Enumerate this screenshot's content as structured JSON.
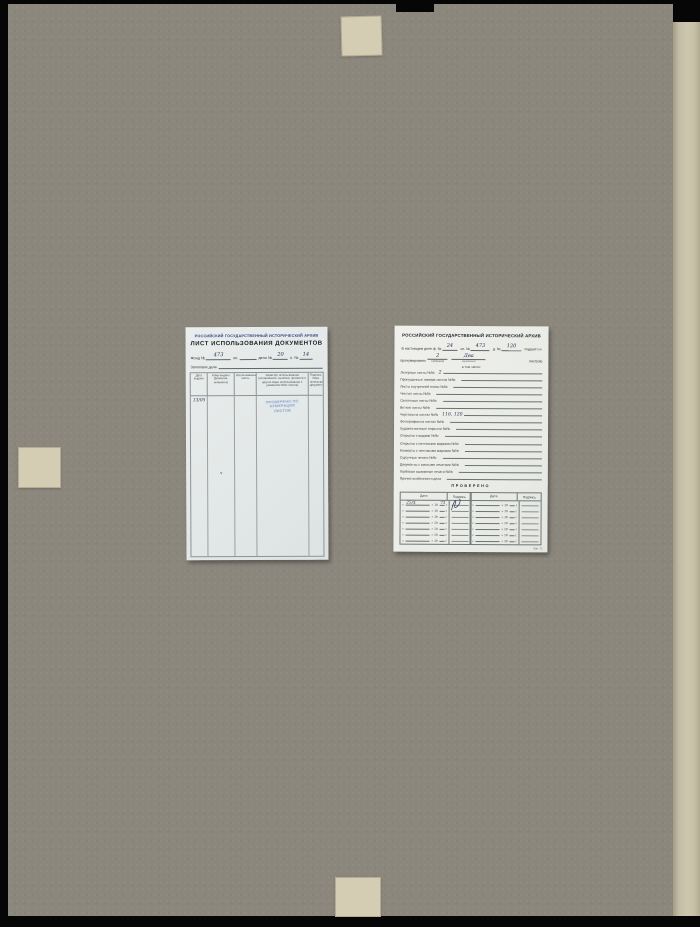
{
  "scene": {
    "backing_color": "#060606",
    "board_color": "#8b877d",
    "page_edge_color": "#c8c2a9",
    "tape_color": "#d4cdb3",
    "stamp_color": "#7b96c8"
  },
  "usage_sheet": {
    "archive": "РОССИЙСКИЙ ГОСУДАРСТВЕННЫЙ ИСТОРИЧЕСКИЙ АРХИВ",
    "title": "ЛИСТ ИСПОЛЬЗОВАНИЯ ДОКУМЕНТОВ",
    "fond_label": "Фонд №",
    "fond_value": "473",
    "op_label": "оп.",
    "op_value": "",
    "delo_label": "дело №",
    "delo_value": "20",
    "list_label": "л. №",
    "list_value": "14",
    "heading_label": "Заголовок дела",
    "columns": [
      "Дата выдачи",
      "Кому выдано (фамилия, инициалы)",
      "Использованные листы",
      "Характер использования (копирование, выписки, просмотр и другие виды использования с указанием №№ листов)",
      "Подпись лица, использовавшего документы"
    ],
    "entry_date": "13/05",
    "entry_mark": "ч",
    "stamp_lines": [
      "ПРОВЕРЕНО ПО",
      "НУМЕРАЦИИ",
      "ЛИСТОВ"
    ]
  },
  "verify_sheet": {
    "archive": "РОССИЙСКИЙ ГОСУДАРСТВЕННЫЙ ИСТОРИЧЕСКИЙ АРХИВ",
    "line1": {
      "label1": "В настоящем деле ф. №",
      "value1": "24",
      "label2": "оп. №",
      "value2": "473",
      "label3": "д. №",
      "value3": "120",
      "tail": "подшито и"
    },
    "line2": {
      "lead": "пронумеровано",
      "value_num": "2",
      "num_label": "(цифрами)",
      "value_text": "Два",
      "text_label": "(прописью)",
      "tail": "лист(ов)"
    },
    "including": "в том числе:",
    "items": [
      {
        "label": "Литерные листы №№",
        "value": "2"
      },
      {
        "label": "Пропущенные номера листов №№",
        "value": ""
      },
      {
        "label": "Листы внутренней описи №№",
        "value": ""
      },
      {
        "label": "Чистые листы №№",
        "value": ""
      },
      {
        "label": "Склеенные листы №№",
        "value": ""
      },
      {
        "label": "Ветхие листы №№",
        "value": ""
      },
      {
        "label": "Чертежи на листах №№",
        "value": "116, 120"
      },
      {
        "label": "Фотографии на листах №№",
        "value": ""
      },
      {
        "label": "Художественные открытки №№",
        "value": ""
      },
      {
        "label": "Открытки с видами №№",
        "value": ""
      },
      {
        "label": "Открытки с почтовыми марками №№",
        "value": ""
      },
      {
        "label": "Конверты с почтовыми марками №№",
        "value": ""
      },
      {
        "label": "Сургучные печати №№",
        "value": ""
      },
      {
        "label": "Документы с вислыми печатями №№",
        "value": ""
      },
      {
        "label": "Гербовые выжимные печати №№",
        "value": ""
      },
      {
        "label": "Прочие особенности дела",
        "value": ""
      }
    ],
    "check": {
      "title": "ПРОВЕРЕНО",
      "date_header": "Дата",
      "sign_header": "Подпись",
      "quote_open": "«",
      "quote_close": "»",
      "year_prefix": "19",
      "year_suffix": "г.",
      "left_rows": [
        {
          "date": "25/X",
          "year": "73"
        },
        {},
        {},
        {},
        {},
        {},
        {}
      ],
      "right_rows": [
        {},
        {},
        {},
        {},
        {},
        {},
        {}
      ]
    },
    "footer": "Зак. 72"
  }
}
